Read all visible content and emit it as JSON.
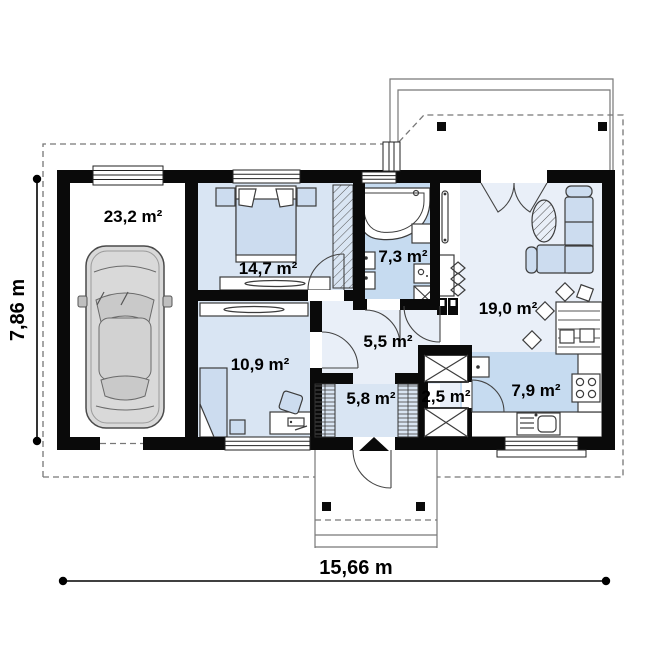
{
  "plan": {
    "rooms": [
      {
        "name": "garage",
        "area": "23,2 m²"
      },
      {
        "name": "bedroom",
        "area": "14,7 m²"
      },
      {
        "name": "bathroom",
        "area": "7,3 m²"
      },
      {
        "name": "living-room",
        "area": "19,0 m²"
      },
      {
        "name": "office",
        "area": "10,9 m²"
      },
      {
        "name": "hallway",
        "area": "5,5 m²"
      },
      {
        "name": "entry",
        "area": "5,8 m²"
      },
      {
        "name": "utility",
        "area": "2,5 m²"
      },
      {
        "name": "kitchen",
        "area": "7,9 m²"
      }
    ],
    "dimensions": {
      "total_width": "15,66 m",
      "total_height": "7,86 m"
    },
    "colors": {
      "wall": "#0a0a0a",
      "floor_light": "#d9e5f3",
      "floor_medium": "#c6dbf0",
      "floor_pale": "#e9eff8",
      "furniture_blue": "#ccdcef",
      "dashed_line": "#777777"
    }
  }
}
